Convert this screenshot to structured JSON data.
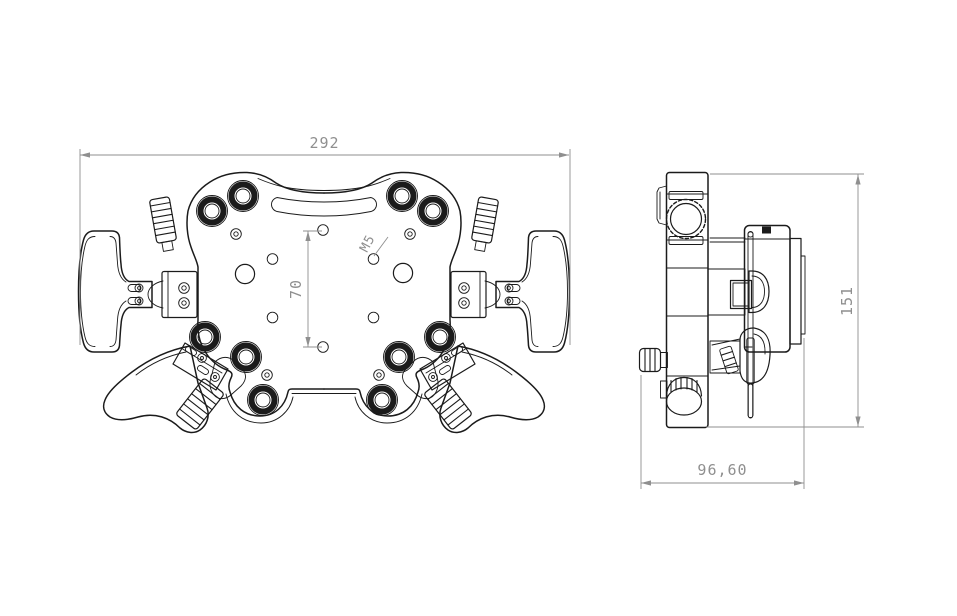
{
  "drawing": {
    "front_view": {
      "overall_width_mm": "292",
      "mount_hole_spacing_mm": "70",
      "mount_hole_thread": "M5"
    },
    "side_view": {
      "overall_height_mm": "151",
      "overall_depth_mm": "96,60"
    }
  },
  "colors": {
    "bg": "#ffffff",
    "line": "#1b1b1b",
    "dim": "#8f8f8f"
  }
}
